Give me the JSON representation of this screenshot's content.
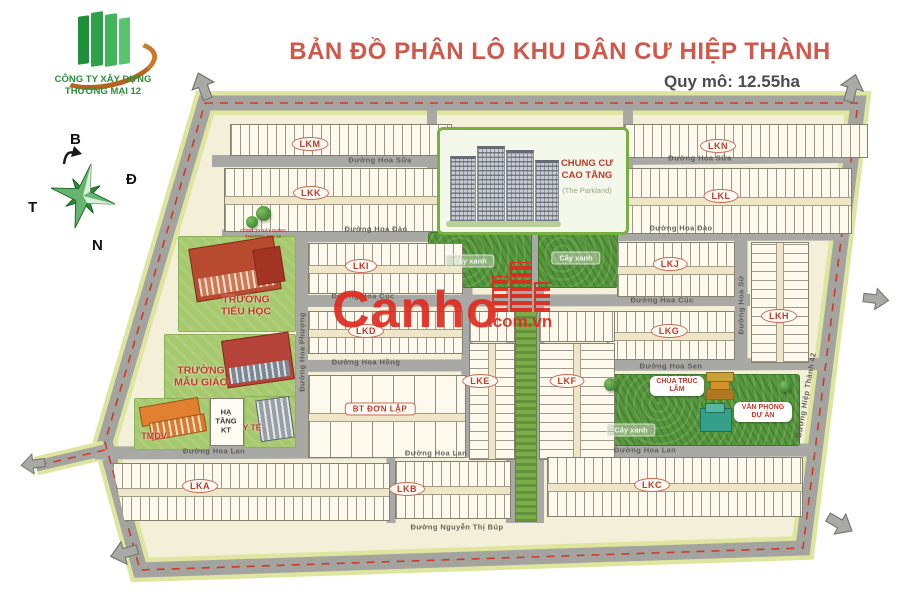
{
  "header": {
    "title": "BẢN ĐỒ PHÂN LÔ KHU DÂN CƯ HIỆP THÀNH",
    "scale": "Quy mô: 12.55ha"
  },
  "logo": {
    "line1": "CÔNG TY XÂY DỰNG",
    "line2": "THƯƠNG MẠI 12"
  },
  "compass": {
    "north": "B",
    "east": "Đ",
    "west": "T",
    "south": "N"
  },
  "watermark": {
    "brand": "Canho",
    "domain": ".com.vn"
  },
  "map": {
    "blocks": {
      "lka": "LKA",
      "lkb": "LKB",
      "lkc": "LKC",
      "lkd": "LKD",
      "lke": "LKE",
      "lkf": "LKF",
      "lkg": "LKG",
      "lkh": "LKH",
      "lki": "LKI",
      "lkj": "LKJ",
      "lkk": "LKK",
      "lkl": "LKL",
      "lkm": "LKM",
      "lkn": "LKN",
      "villa": "BT ĐƠN LẬP"
    },
    "streets": {
      "hoa_sua": "Đường Hoa Sữa",
      "hoa_dao": "Đường Hoa Đào",
      "hoa_cuc": "Đường Hoa Cúc",
      "hoa_hong": "Đường Hoa Hồng",
      "hoa_sen": "Đường Hoa Sen",
      "hoa_lan": "Đường Hoa Lan",
      "hoa_phuong": "Đường Hoa Phượng",
      "hoa_su": "Đường Hoa Sứ",
      "hiep_thanh": "Đường Hiệp Thành 42",
      "nguyen_thi_bup": "Đường Nguyễn Thị Búp"
    },
    "facilities": {
      "apartment_line1": "CHUNG CƯ",
      "apartment_line2": "CAO TẦNG",
      "apartment_sub": "(The Parkland)",
      "primary_school": "TRƯỜNG TIỂU HỌC",
      "kindergarten": "TRƯỜNG MẪU GIÁO",
      "tmdv": "TMDV",
      "infrastructure": "HẠ TẦNG KT",
      "medical": "Y TẾ",
      "pagoda": "CHÙA TRÚC LÂM",
      "project_office": "VĂN PHÒNG DỰ ÁN",
      "green_area": "Cây xanh"
    },
    "small_watermark": {
      "line1": "CÔNG TY XÂY DỰNG",
      "line2": "THƯƠNG MẠI 12"
    }
  }
}
